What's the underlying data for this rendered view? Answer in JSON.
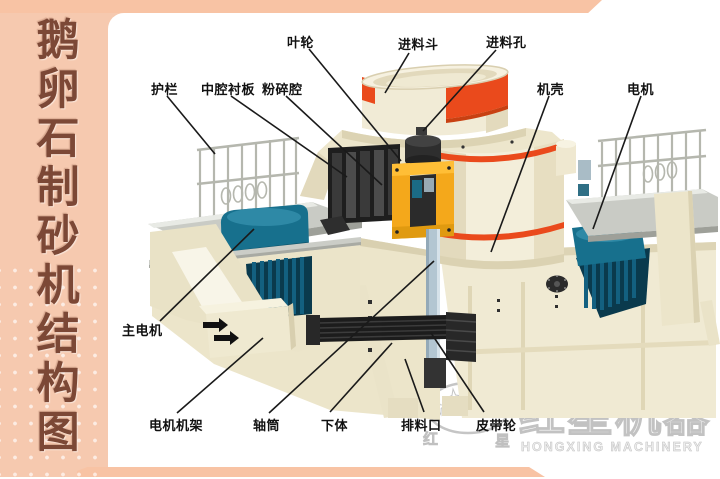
{
  "sidebar": {
    "title": "鹅卵石制砂机结构图"
  },
  "diagram": {
    "labels": {
      "impeller": "叶轮",
      "feed_hopper": "进料斗",
      "feed_hole": "进料孔",
      "guardrail": "护栏",
      "cavity_liner": "中腔衬板",
      "crushing_chamber": "粉碎腔",
      "casing": "机壳",
      "motor": "电机",
      "main_motor": "主电机",
      "motor_frame": "电机机架",
      "shaft_tube": "轴筒",
      "lower_body": "下体",
      "discharge_port": "排料口",
      "belt_pulley": "皮带轮"
    }
  },
  "watermark": {
    "cn_small_left": "红",
    "cn_small_right": "星",
    "registered": "®",
    "brand_cn": "红星机器",
    "brand_en": "HONGXING MACHINERY"
  },
  "colors": {
    "sidebar_bg": "#f6c9af",
    "band": "#f8c3a4",
    "title_text": "#7c4836",
    "machine_cream": "#f0ead3",
    "stripe_red": "#ea4a1c",
    "motor_teal": "#17708d",
    "impeller_orange": "#f4a81b",
    "watermark_gray": "#c6c6c6",
    "label_text": "#111111"
  }
}
